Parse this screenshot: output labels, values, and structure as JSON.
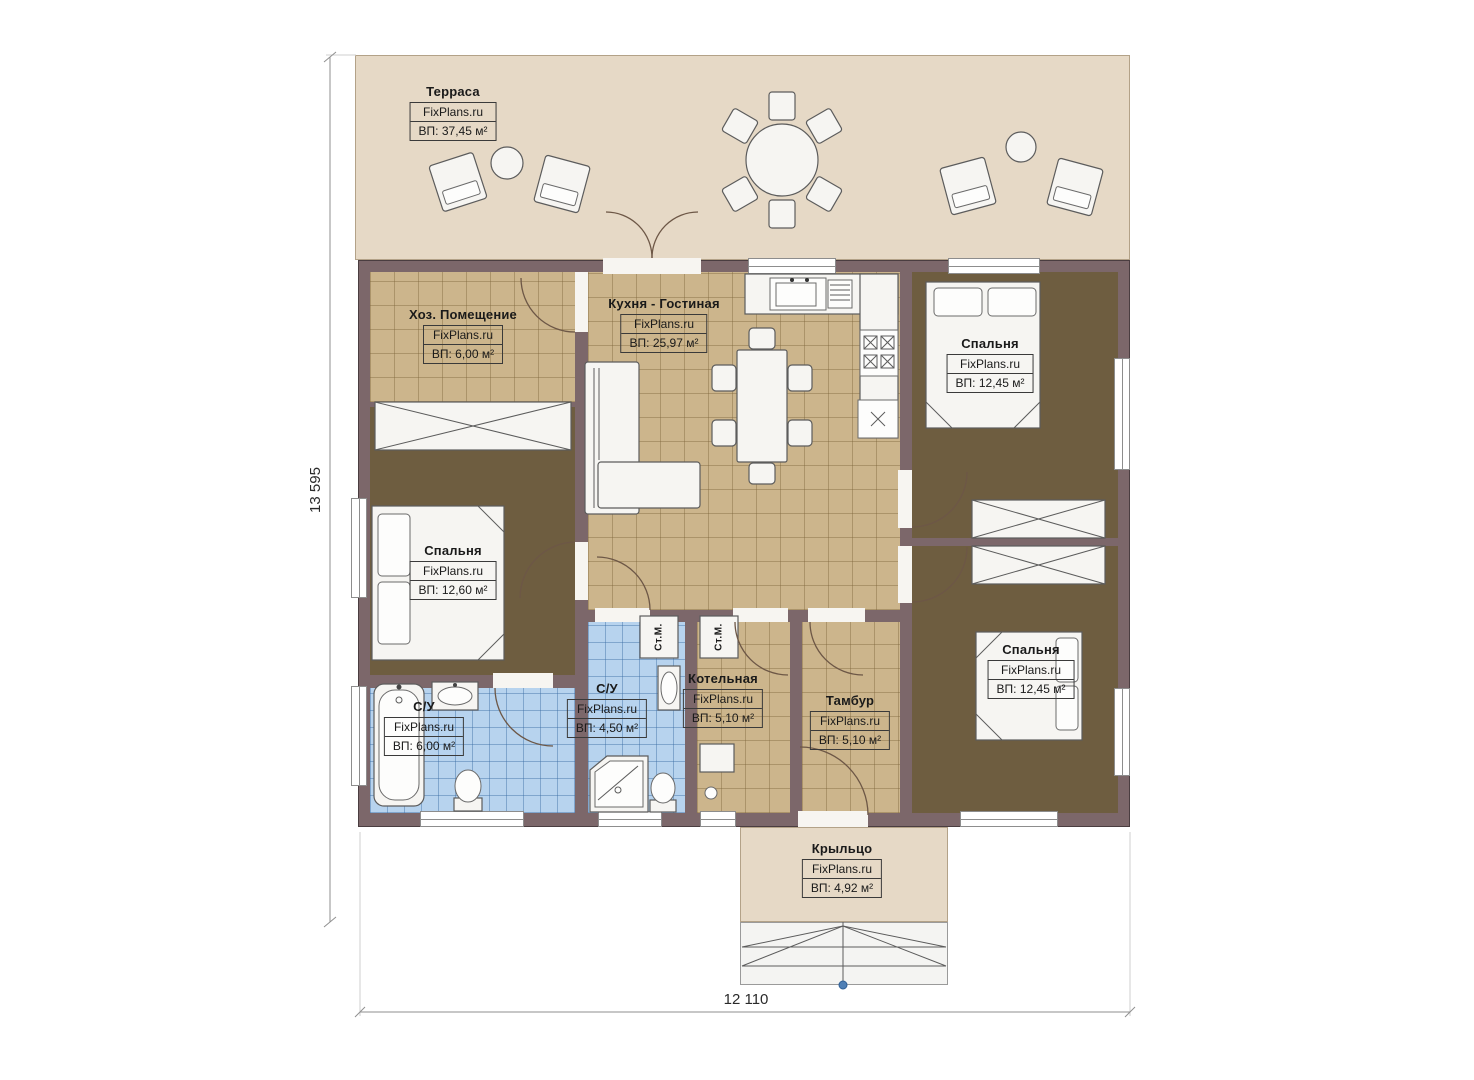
{
  "plan": {
    "brand": "FixPlans.ru",
    "rooms": [
      {
        "id": "terrace",
        "name": "Терраса",
        "area": "ВП: 37,45 м²"
      },
      {
        "id": "utility",
        "name": "Хоз. Помещение",
        "area": "ВП: 6,00 м²"
      },
      {
        "id": "kitchen",
        "name": "Кухня - Гостиная",
        "area": "ВП: 25,97 м²"
      },
      {
        "id": "bedroom-1",
        "name": "Спальня",
        "area": "ВП: 12,45 м²"
      },
      {
        "id": "bedroom-2",
        "name": "Спальня",
        "area": "ВП: 12,60 м²"
      },
      {
        "id": "su-1",
        "name": "С/У",
        "area": "ВП: 6,00 м²"
      },
      {
        "id": "su-2",
        "name": "С/У",
        "area": "ВП: 4,50 м²"
      },
      {
        "id": "boiler",
        "name": "Котельная",
        "area": "ВП: 5,10 м²"
      },
      {
        "id": "tambour",
        "name": "Тамбур",
        "area": "ВП: 5,10 м²"
      },
      {
        "id": "bedroom-3",
        "name": "Спальня",
        "area": "ВП: 12,45 м²"
      },
      {
        "id": "porch",
        "name": "Крыльцо",
        "area": "ВП: 4,92 м²"
      }
    ],
    "fixtures": {
      "washer_label": "Ст.М."
    },
    "dimensions": {
      "height": "13 595",
      "width": "12 110"
    },
    "colors": {
      "wall": "#7c676a",
      "terrace": "#e6d9c6",
      "floor_tan": "#ccb58c",
      "floor_dark": "#6e5d40",
      "tile_blue": "#b7d3ee"
    }
  }
}
